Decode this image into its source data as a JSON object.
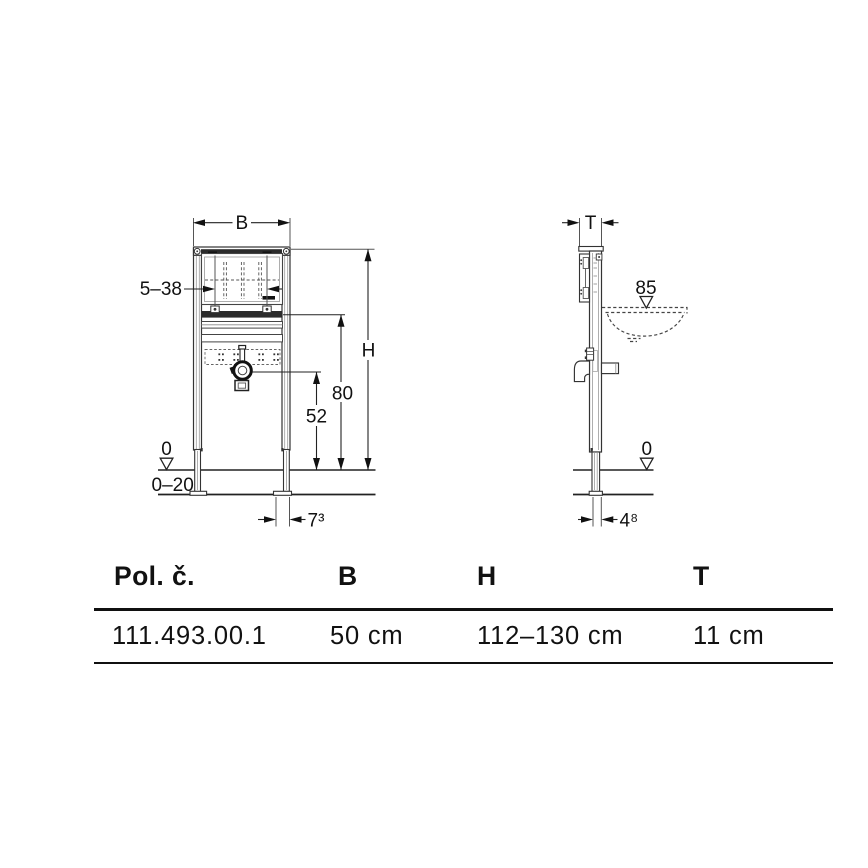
{
  "colors": {
    "ink": "#111111",
    "thin_line": "#555555",
    "dark_fill": "#2b2b2b"
  },
  "front_view": {
    "width_label": "B",
    "height_label": "H",
    "plate_adjust_range": "5–38",
    "crossbar_height": "80",
    "trap_height": "52",
    "zero_level": "0",
    "floor_adjust_range": "0–20",
    "foot_dim": "7³"
  },
  "side_view": {
    "depth_label": "T",
    "basin_rim_height": "85",
    "zero_level": "0",
    "foot_dim": "4⁸"
  },
  "table": {
    "headers": [
      "Pol. č.",
      "B",
      "H",
      "T"
    ],
    "rows": [
      {
        "article": "111.493.00.1",
        "b": "50 cm",
        "h": "112–130 cm",
        "t": "11 cm"
      }
    ]
  }
}
